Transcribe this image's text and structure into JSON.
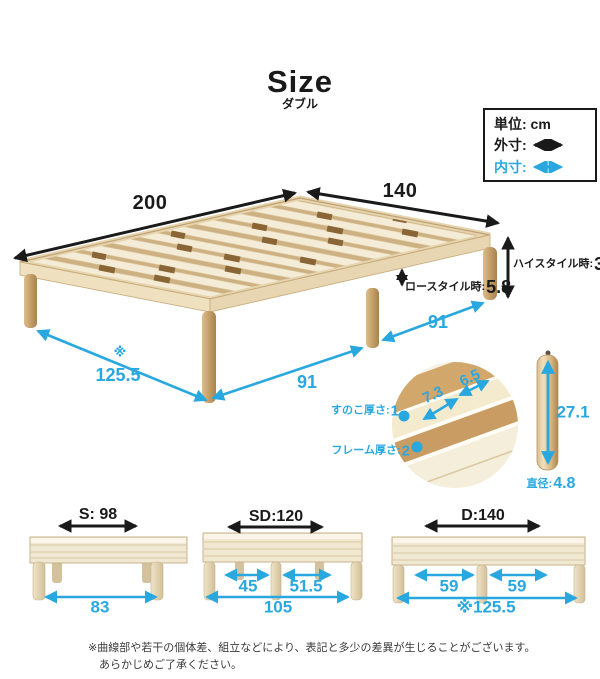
{
  "page": {
    "title": "Size",
    "subtitle": "ダブル"
  },
  "legend": {
    "unit_label": "単位: cm",
    "outer_label": "外寸:",
    "inner_label": "内寸:"
  },
  "main_diagram": {
    "length": "200",
    "width": "140",
    "high_style_label": "ハイスタイル時:",
    "high_style_value": "33",
    "low_style_label": "ロースタイル時:",
    "low_style_value": "5.8",
    "inner_note_mark": "※",
    "inner_length": "125.5",
    "leg_span_front": "91",
    "leg_span_side": "91",
    "slat_thickness_label": "すのこ厚さ:",
    "slat_thickness_value": "1",
    "frame_thickness_label": "フレーム厚さ:",
    "frame_thickness_value": "2",
    "slat_detail_width": "7.3",
    "slat_detail_pitch": "6.5",
    "leg_height": "27.1",
    "leg_diameter_label": "直径:",
    "leg_diameter_value": "4.8"
  },
  "size_variants": [
    {
      "name_label": "S: 98",
      "inner_left": "",
      "inner_right": "",
      "overall": "83"
    },
    {
      "name_label": "SD:120",
      "inner_left": "45",
      "inner_right": "51.5",
      "overall": "105"
    },
    {
      "name_label": "D:140",
      "inner_left": "59",
      "inner_right": "59",
      "overall": "※125.5"
    }
  ],
  "footnote": {
    "line1": "※曲線部や若干の個体差、組立などにより、表記と多少の差異が生じることがございます。",
    "line2": "あらかじめご了承ください。"
  },
  "colors": {
    "accent_blue": "#29a8e0",
    "ink": "#1a1a1a",
    "wood_light": "#f4ecd6",
    "wood_mid": "#cfb183",
    "wood_leg": "#c9a36e"
  }
}
